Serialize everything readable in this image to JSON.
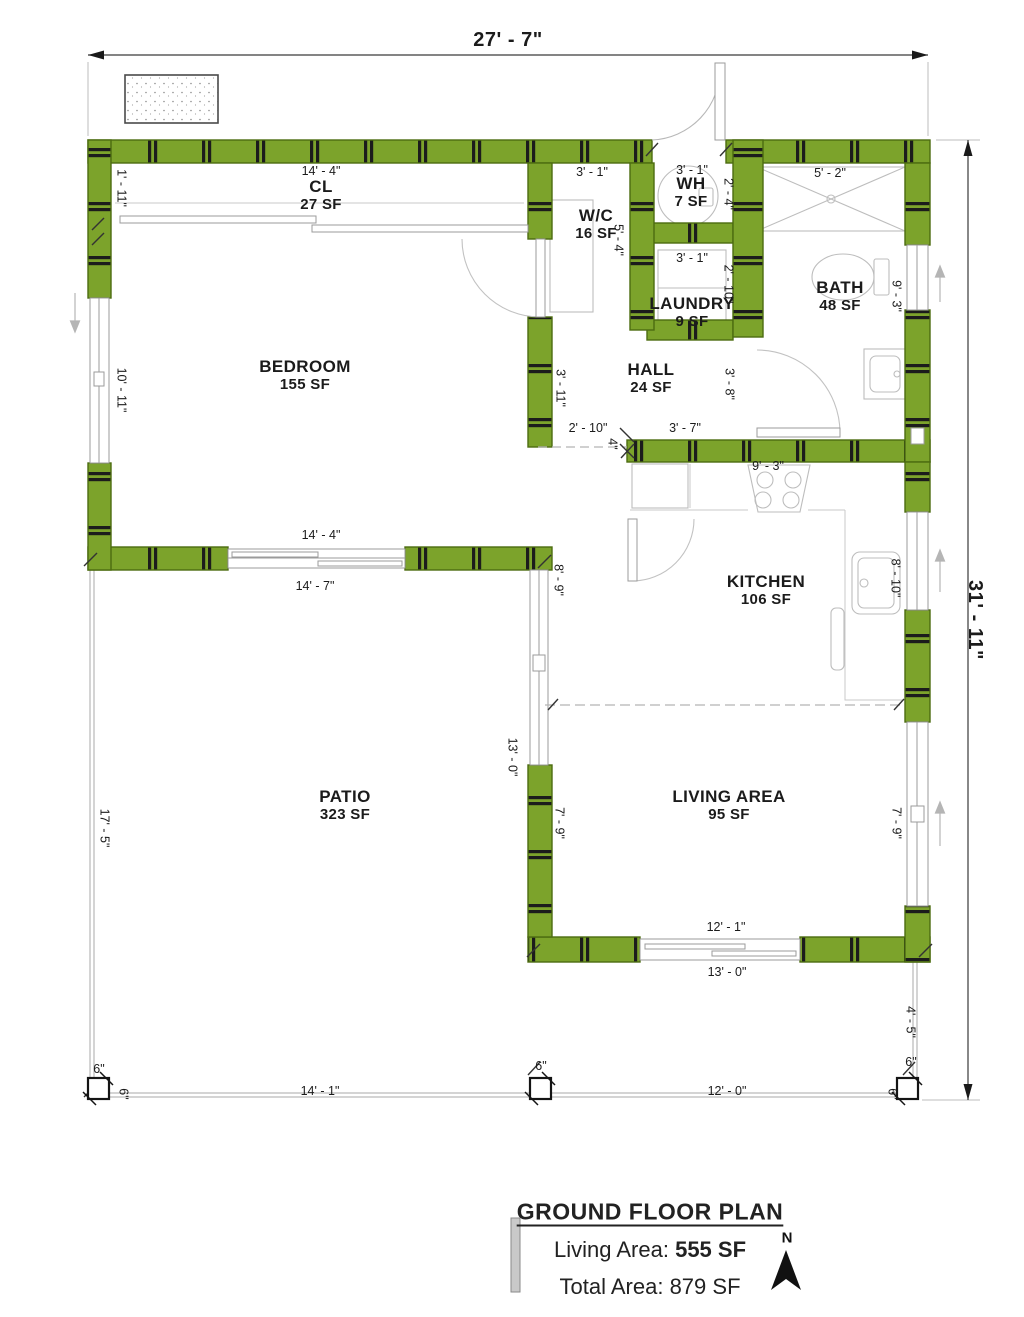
{
  "overall": {
    "width_dim": "27' - 7\"",
    "height_dim": "31' - 11\""
  },
  "rooms": [
    {
      "name": "CL",
      "area": "27 SF"
    },
    {
      "name": "BEDROOM",
      "area": "155 SF"
    },
    {
      "name": "W/C",
      "area": "16 SF"
    },
    {
      "name": "WH",
      "area": "7 SF"
    },
    {
      "name": "LAUNDRY",
      "area": "9 SF"
    },
    {
      "name": "HALL",
      "area": "24 SF"
    },
    {
      "name": "BATH",
      "area": "48 SF"
    },
    {
      "name": "KITCHEN",
      "area": "106 SF"
    },
    {
      "name": "LIVING AREA",
      "area": "95 SF"
    },
    {
      "name": "PATIO",
      "area": "323 SF"
    }
  ],
  "dims": {
    "cl_width": "14' - 4\"",
    "cl_depth": "1' - 11\"",
    "bedroom_height": "10' - 11\"",
    "bedroom_width": "14' - 4\"",
    "wc_width": "3' - 1\"",
    "wc_height": "5' - 4\"",
    "wh_width": "3' - 1\"",
    "wh_height": "2' - 4\"",
    "laundry_width": "3' - 1\"",
    "laundry_height": "2' - 10\"",
    "hall_left": "3' - 11\"",
    "hall_right": "3' - 8\"",
    "hall_bottom_left": "2' - 10\"",
    "hall_bottom_right": "3' - 7\"",
    "wall_thickness": "4\"",
    "bath_width": "5' - 2\"",
    "bath_height": "9' - 3\"",
    "kitchen_width": "9' - 3\"",
    "kitchen_left": "8' - 9\"",
    "kitchen_right": "8' - 10\"",
    "west_height": "13' - 0\"",
    "living_left": "7' - 9\"",
    "living_right": "7' - 9\"",
    "living_door": "12' - 1\"",
    "living_bottom": "13' - 0\"",
    "patio_top": "14' - 7\"",
    "patio_left": "17' - 5\"",
    "deck_bottom_left": "14' - 1\"",
    "deck_bottom_right": "12' - 0\"",
    "deck_right": "4' - 5\"",
    "post_size": "6\""
  },
  "title_block": {
    "title": "GROUND FLOOR PLAN",
    "living_area_label": "Living Area:",
    "living_area_value": "555 SF",
    "total_area_label": "Total Area:",
    "total_area_value": "879 SF",
    "north_label": "N"
  },
  "colors": {
    "wall_fill": "#7CA32B",
    "wall_outline": "#4C6C10",
    "line_gray": "#9B9B9B",
    "text": "#1B1B1B"
  }
}
